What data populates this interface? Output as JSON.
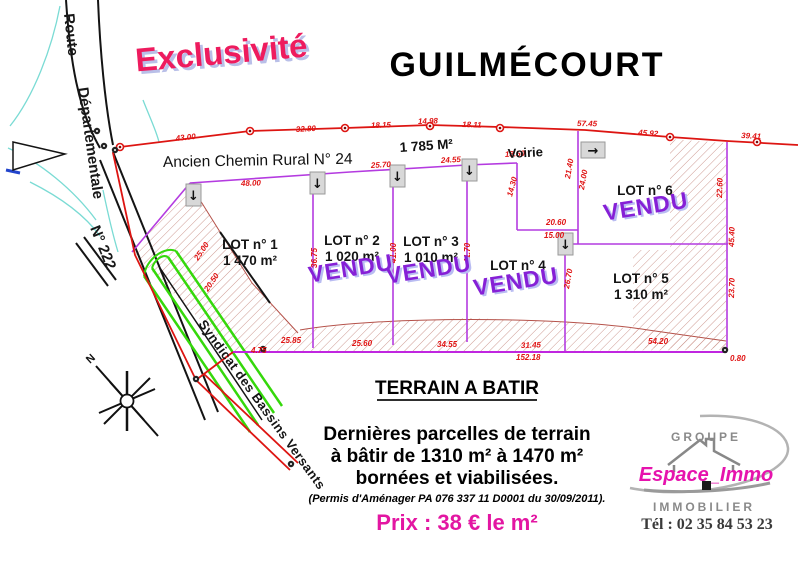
{
  "banner": "Exclusivité",
  "title": "GUILMÉCOURT",
  "plan": {
    "road": {
      "route": "Route",
      "departementale": "Départementale",
      "numero": "N° 222"
    },
    "ancien_chemin": "Ancien Chemin Rural N° 24",
    "voirie": "Voirie",
    "voirie_area": "1 785 M²",
    "north": "N",
    "syndicat": "Syndicat des Bassins Versants",
    "vendu_label": "VENDU",
    "lots": [
      {
        "label": "LOT n° 1",
        "area": "1 470 m²",
        "sold": false,
        "x": 250,
        "y": 249,
        "ax": 250,
        "ay": 265
      },
      {
        "label": "LOT n° 2",
        "area": "1 020 m²",
        "sold": true,
        "x": 352,
        "y": 245,
        "ax": 352,
        "ay": 261,
        "vx": 352,
        "vy": 276
      },
      {
        "label": "LOT n° 3",
        "area": "1 010 m²",
        "sold": true,
        "x": 431,
        "y": 246,
        "ax": 431,
        "ay": 262,
        "vx": 430,
        "vy": 277
      },
      {
        "label": "LOT n° 4",
        "area": "",
        "sold": true,
        "x": 518,
        "y": 270,
        "vx": 517,
        "vy": 289
      },
      {
        "label": "LOT n° 5",
        "area": "1 310 m²",
        "sold": false,
        "x": 641,
        "y": 283,
        "ax": 641,
        "ay": 299
      },
      {
        "label": "LOT n° 6",
        "area": "",
        "sold": true,
        "x": 645,
        "y": 195,
        "vx": 647,
        "vy": 214
      }
    ],
    "dimensions": [
      {
        "t": "43.00",
        "x": 176,
        "y": 141,
        "r": -6
      },
      {
        "t": "32.80",
        "x": 296,
        "y": 132,
        "r": -3
      },
      {
        "t": "18.15",
        "x": 371,
        "y": 128,
        "r": -2
      },
      {
        "t": "14.98",
        "x": 418,
        "y": 124,
        "r": -2
      },
      {
        "t": "18.11",
        "x": 462,
        "y": 127,
        "r": 2
      },
      {
        "t": "57.45",
        "x": 577,
        "y": 126,
        "r": 1
      },
      {
        "t": "45.92",
        "x": 638,
        "y": 135,
        "r": 4
      },
      {
        "t": "39.41",
        "x": 741,
        "y": 138,
        "r": 3
      },
      {
        "t": "48.00",
        "x": 241,
        "y": 186,
        "r": -2
      },
      {
        "t": "25.70",
        "x": 371,
        "y": 168,
        "r": -3
      },
      {
        "t": "24.55",
        "x": 441,
        "y": 163,
        "r": -3
      },
      {
        "t": "18.50",
        "x": 505,
        "y": 157,
        "r": -3
      },
      {
        "t": "36.75",
        "x": 317,
        "y": 268,
        "r": -90
      },
      {
        "t": "41.00",
        "x": 396,
        "y": 263,
        "r": -90
      },
      {
        "t": "41.70",
        "x": 470,
        "y": 263,
        "r": -90
      },
      {
        "t": "14.30",
        "x": 512,
        "y": 197,
        "r": -75
      },
      {
        "t": "20.60",
        "x": 546,
        "y": 225,
        "r": 0
      },
      {
        "t": "15.00",
        "x": 544,
        "y": 238,
        "r": 0
      },
      {
        "t": "21.40",
        "x": 570,
        "y": 179,
        "r": -80
      },
      {
        "t": "24.00",
        "x": 584,
        "y": 190,
        "r": -80
      },
      {
        "t": "26.70",
        "x": 569,
        "y": 289,
        "r": -80
      },
      {
        "t": "22.60",
        "x": 722,
        "y": 198,
        "r": -88
      },
      {
        "t": "45.40",
        "x": 734,
        "y": 247,
        "r": -88
      },
      {
        "t": "23.70",
        "x": 734,
        "y": 298,
        "r": -88
      },
      {
        "t": "25.00",
        "x": 198,
        "y": 261,
        "r": -56
      },
      {
        "t": "20.50",
        "x": 208,
        "y": 292,
        "r": -56
      },
      {
        "t": "25.85",
        "x": 281,
        "y": 343,
        "r": 0
      },
      {
        "t": "25.60",
        "x": 352,
        "y": 346,
        "r": 0
      },
      {
        "t": "34.55",
        "x": 437,
        "y": 347,
        "r": 0
      },
      {
        "t": "31.45",
        "x": 521,
        "y": 348,
        "r": -2
      },
      {
        "t": "54.20",
        "x": 648,
        "y": 344,
        "r": 0
      },
      {
        "t": "152.18",
        "x": 516,
        "y": 360,
        "r": 0
      },
      {
        "t": "4.75",
        "x": 251,
        "y": 353,
        "r": 0
      },
      {
        "t": "0.80",
        "x": 730,
        "y": 361,
        "r": 0
      }
    ],
    "entrance_markers": [
      {
        "x": 186,
        "y": 184,
        "w": 15,
        "h": 22,
        "arrow": "↓"
      },
      {
        "x": 310,
        "y": 172,
        "w": 15,
        "h": 22,
        "arrow": "↓"
      },
      {
        "x": 390,
        "y": 165,
        "w": 15,
        "h": 22,
        "arrow": "↓"
      },
      {
        "x": 462,
        "y": 159,
        "w": 15,
        "h": 22,
        "arrow": "↓"
      },
      {
        "x": 558,
        "y": 233,
        "w": 15,
        "h": 22,
        "arrow": "↓"
      },
      {
        "x": 581,
        "y": 142,
        "w": 24,
        "h": 16,
        "arrow": "→"
      }
    ],
    "red_points": [
      [
        120,
        147
      ],
      [
        250,
        131
      ],
      [
        345,
        128
      ],
      [
        430,
        126
      ],
      [
        500,
        128
      ],
      [
        670,
        137
      ],
      [
        757,
        142
      ]
    ],
    "black_points": [
      [
        263,
        349
      ],
      [
        725,
        350
      ],
      [
        196,
        379
      ],
      [
        104,
        146
      ],
      [
        97,
        131
      ],
      [
        115,
        150
      ],
      [
        291,
        464
      ]
    ]
  },
  "footer": {
    "heading": "TERRAIN A BATIR",
    "line1": "Dernières parcelles de terrain",
    "line2": "à bâtir de 1310 m² à 1470 m²",
    "line3": "bornées et viabilisées.",
    "permit": "(Permis d'Aménager PA 076 337 11 D0001 du 30/09/2011).",
    "price": "Prix : 38 € le m²"
  },
  "logo": {
    "groupe": "GROUPE",
    "name": "Espace_Immo",
    "immobilier": "IMMOBILIER",
    "phone": "Tél : 02 35 84 53 23"
  },
  "colors": {
    "banner_pink": "#ee1b5e",
    "vendu_purple": "#8620d6",
    "price_magenta": "#e316a2",
    "logo_magenta": "#e613ad",
    "line_red": "#dd1512",
    "lot_purple": "#b43be0",
    "road_green": "#35d80b"
  }
}
